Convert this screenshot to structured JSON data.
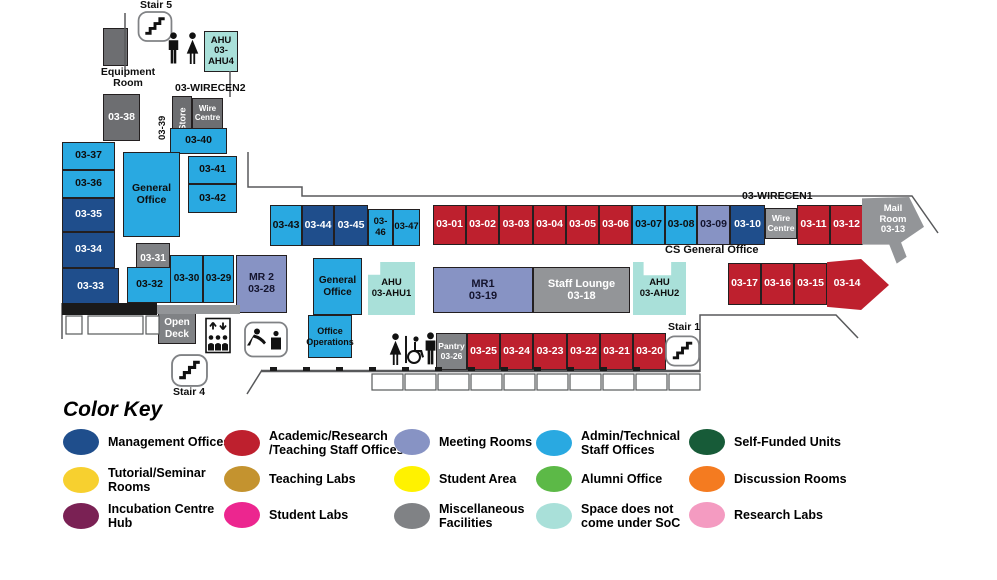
{
  "palette": {
    "admin_technical": "#29A9E1",
    "management": "#1F4E8C",
    "academic": "#BE202E",
    "meeting": "#8793C4",
    "misc_dark": "#6D6E71",
    "misc": "#808285",
    "misc_light": "#939598",
    "not_soc": "#A9E0D9",
    "tutorial": "#F7D02F",
    "teaching_labs": "#C4932F",
    "student_area": "#FFF200",
    "alumni": "#5CB947",
    "self_funded": "#175B38",
    "discussion": "#F47B20",
    "incubation": "#7A2154",
    "student_labs": "#EC268F",
    "research": "#F49BC1"
  },
  "map": {
    "rooms": [
      {
        "name": "room-equipment-box",
        "label": "",
        "x": 103,
        "y": 28,
        "w": 25,
        "h": 38,
        "bg": "#6D6E71",
        "fg": "#fff",
        "fs": 10
      },
      {
        "name": "room-ahu4",
        "label": "AHU\n03-AHU4",
        "x": 204,
        "y": 31,
        "w": 34,
        "h": 41,
        "bg": "#A9E0D9",
        "fg": "#0e0e0e",
        "fs": 9.5
      },
      {
        "name": "room-03-38",
        "label": "03-38",
        "x": 103,
        "y": 94,
        "w": 37,
        "h": 47,
        "bg": "#6D6E71",
        "fg": "#fff",
        "fs": 10.5
      },
      {
        "name": "room-store",
        "label": "Store",
        "x": 172,
        "y": 96,
        "w": 20,
        "h": 47,
        "bg": "#6D6E71",
        "fg": "#fff",
        "fs": 9,
        "vertical": true
      },
      {
        "name": "room-wire-centre-2",
        "label": "Wire\nCentre",
        "x": 192,
        "y": 98,
        "w": 31,
        "h": 31,
        "bg": "#6D6E71",
        "fg": "#fff",
        "fs": 8
      },
      {
        "name": "room-03-40",
        "label": "03-40",
        "x": 170,
        "y": 128,
        "w": 57,
        "h": 26,
        "bg": "#29A9E1",
        "fg": "#0e0e0e",
        "fs": 10.5
      },
      {
        "name": "room-03-37",
        "label": "03-37",
        "x": 62,
        "y": 142,
        "w": 53,
        "h": 28,
        "bg": "#29A9E1",
        "fg": "#0e0e0e",
        "fs": 10.5
      },
      {
        "name": "room-03-36",
        "label": "03-36",
        "x": 62,
        "y": 170,
        "w": 53,
        "h": 28,
        "bg": "#29A9E1",
        "fg": "#0e0e0e",
        "fs": 10.5
      },
      {
        "name": "room-03-35",
        "label": "03-35",
        "x": 62,
        "y": 198,
        "w": 53,
        "h": 34,
        "bg": "#1F4E8C",
        "fg": "#fff",
        "fs": 10.5
      },
      {
        "name": "room-03-34",
        "label": "03-34",
        "x": 62,
        "y": 232,
        "w": 53,
        "h": 36,
        "bg": "#1F4E8C",
        "fg": "#fff",
        "fs": 10.5
      },
      {
        "name": "room-03-33",
        "label": "03-33",
        "x": 62,
        "y": 268,
        "w": 57,
        "h": 37,
        "bg": "#1F4E8C",
        "fg": "#fff",
        "fs": 10.5
      },
      {
        "name": "room-general-office-west",
        "label": "General\nOffice",
        "x": 123,
        "y": 152,
        "w": 57,
        "h": 85,
        "bg": "#29A9E1",
        "fg": "#0e0e0e",
        "fs": 10.5
      },
      {
        "name": "room-03-41",
        "label": "03-41",
        "x": 188,
        "y": 156,
        "w": 49,
        "h": 28,
        "bg": "#29A9E1",
        "fg": "#0e0e0e",
        "fs": 10.5
      },
      {
        "name": "room-03-42",
        "label": "03-42",
        "x": 188,
        "y": 184,
        "w": 49,
        "h": 29,
        "bg": "#29A9E1",
        "fg": "#0e0e0e",
        "fs": 10.5
      },
      {
        "name": "room-03-31",
        "label": "03-31",
        "x": 136,
        "y": 243,
        "w": 34,
        "h": 32,
        "bg": "#808285",
        "fg": "#fff",
        "fs": 10
      },
      {
        "name": "room-03-32",
        "label": "03-32",
        "x": 127,
        "y": 267,
        "w": 45,
        "h": 36,
        "bg": "#29A9E1",
        "fg": "#0e0e0e",
        "fs": 10.5
      },
      {
        "name": "room-03-30",
        "label": "03-30",
        "x": 170,
        "y": 255,
        "w": 33,
        "h": 48,
        "bg": "#29A9E1",
        "fg": "#0e0e0e",
        "fs": 10
      },
      {
        "name": "room-03-29",
        "label": "03-29",
        "x": 203,
        "y": 255,
        "w": 31,
        "h": 48,
        "bg": "#29A9E1",
        "fg": "#0e0e0e",
        "fs": 10
      },
      {
        "name": "room-mr2",
        "label": "MR 2\n03-28",
        "x": 236,
        "y": 255,
        "w": 51,
        "h": 58,
        "bg": "#8793C4",
        "fg": "#14142e",
        "fs": 10.5
      },
      {
        "name": "room-open-deck",
        "label": "Open\nDeck",
        "x": 158,
        "y": 313,
        "w": 38,
        "h": 31,
        "bg": "#808285",
        "fg": "#fff",
        "fs": 10
      },
      {
        "name": "room-03-43",
        "label": "03-43",
        "x": 270,
        "y": 205,
        "w": 32,
        "h": 41,
        "bg": "#29A9E1",
        "fg": "#0e0e0e",
        "fs": 10.5
      },
      {
        "name": "room-03-44",
        "label": "03-44",
        "x": 302,
        "y": 205,
        "w": 32,
        "h": 41,
        "bg": "#1F4E8C",
        "fg": "#fff",
        "fs": 10.5
      },
      {
        "name": "room-03-45",
        "label": "03-45",
        "x": 334,
        "y": 205,
        "w": 34,
        "h": 41,
        "bg": "#1F4E8C",
        "fg": "#fff",
        "fs": 10.5
      },
      {
        "name": "room-03-46",
        "label": "03-46",
        "x": 368,
        "y": 209,
        "w": 25,
        "h": 37,
        "bg": "#29A9E1",
        "fg": "#0e0e0e",
        "fs": 9.5
      },
      {
        "name": "room-03-47",
        "label": "03-47",
        "x": 393,
        "y": 209,
        "w": 27,
        "h": 37,
        "bg": "#29A9E1",
        "fg": "#0e0e0e",
        "fs": 9.5
      },
      {
        "name": "room-general-office-mid",
        "label": "General\nOffice",
        "x": 313,
        "y": 258,
        "w": 49,
        "h": 57,
        "bg": "#29A9E1",
        "fg": "#0e0e0e",
        "fs": 10
      },
      {
        "name": "room-office-operations",
        "label": "Office\nOperations",
        "x": 308,
        "y": 315,
        "w": 44,
        "h": 43,
        "bg": "#29A9E1",
        "fg": "#0e0e0e",
        "fs": 9
      },
      {
        "name": "room-ahu1",
        "label": "AHU\n03-AHU1",
        "x": 368,
        "y": 262,
        "w": 47,
        "h": 53,
        "bg": "#A9E0D9",
        "fg": "#0e0e0e",
        "fs": 9.5,
        "clip": "polygon(0 24%, 26% 24%, 26% 0, 100% 0, 100% 100%, 0 100%)"
      },
      {
        "name": "room-03-01",
        "label": "03-01",
        "x": 433,
        "y": 205,
        "w": 33,
        "h": 40,
        "bg": "#BE202E",
        "fg": "#fff",
        "fs": 10.5
      },
      {
        "name": "room-03-02",
        "label": "03-02",
        "x": 466,
        "y": 205,
        "w": 33,
        "h": 40,
        "bg": "#BE202E",
        "fg": "#fff",
        "fs": 10.5
      },
      {
        "name": "room-03-03",
        "label": "03-03",
        "x": 499,
        "y": 205,
        "w": 34,
        "h": 40,
        "bg": "#BE202E",
        "fg": "#fff",
        "fs": 10.5
      },
      {
        "name": "room-03-04",
        "label": "03-04",
        "x": 533,
        "y": 205,
        "w": 33,
        "h": 40,
        "bg": "#BE202E",
        "fg": "#fff",
        "fs": 10.5
      },
      {
        "name": "room-03-05",
        "label": "03-05",
        "x": 566,
        "y": 205,
        "w": 33,
        "h": 40,
        "bg": "#BE202E",
        "fg": "#fff",
        "fs": 10.5
      },
      {
        "name": "room-03-06",
        "label": "03-06",
        "x": 599,
        "y": 205,
        "w": 33,
        "h": 40,
        "bg": "#BE202E",
        "fg": "#fff",
        "fs": 10.5
      },
      {
        "name": "room-03-07",
        "label": "03-07",
        "x": 632,
        "y": 205,
        "w": 33,
        "h": 40,
        "bg": "#29A9E1",
        "fg": "#0e0e0e",
        "fs": 10.5
      },
      {
        "name": "room-03-08",
        "label": "03-08",
        "x": 665,
        "y": 205,
        "w": 32,
        "h": 40,
        "bg": "#29A9E1",
        "fg": "#0e0e0e",
        "fs": 10.5
      },
      {
        "name": "room-03-09",
        "label": "03-09",
        "x": 697,
        "y": 205,
        "w": 33,
        "h": 40,
        "bg": "#8793C4",
        "fg": "#14142e",
        "fs": 10.5
      },
      {
        "name": "room-03-10",
        "label": "03-10",
        "x": 730,
        "y": 205,
        "w": 35,
        "h": 40,
        "bg": "#1F4E8C",
        "fg": "#fff",
        "fs": 10.5
      },
      {
        "name": "room-wire-centre-1",
        "label": "Wire\nCentre",
        "x": 765,
        "y": 208,
        "w": 32,
        "h": 31,
        "bg": "#939598",
        "fg": "#fff",
        "fs": 8.5
      },
      {
        "name": "room-03-11",
        "label": "03-11",
        "x": 797,
        "y": 205,
        "w": 33,
        "h": 40,
        "bg": "#BE202E",
        "fg": "#fff",
        "fs": 10.5
      },
      {
        "name": "room-03-12",
        "label": "03-12",
        "x": 830,
        "y": 205,
        "w": 33,
        "h": 40,
        "bg": "#BE202E",
        "fg": "#fff",
        "fs": 10.5
      },
      {
        "name": "room-mail-room",
        "label": "Mail\nRoom\n03-13",
        "x": 862,
        "y": 197,
        "w": 62,
        "h": 68,
        "bg": "#939598",
        "fg": "#fff",
        "fs": 9.5,
        "clip": "polygon(0 2%, 76% 0, 100% 44%, 63% 67%, 72% 88%, 56% 98%, 44% 70%, 0 70%)",
        "padB": 22
      },
      {
        "name": "room-03-17",
        "label": "03-17",
        "x": 728,
        "y": 263,
        "w": 33,
        "h": 42,
        "bg": "#BE202E",
        "fg": "#fff",
        "fs": 10.5
      },
      {
        "name": "room-03-16",
        "label": "03-16",
        "x": 761,
        "y": 263,
        "w": 33,
        "h": 42,
        "bg": "#BE202E",
        "fg": "#fff",
        "fs": 10.5
      },
      {
        "name": "room-03-15",
        "label": "03-15",
        "x": 794,
        "y": 263,
        "w": 33,
        "h": 42,
        "bg": "#BE202E",
        "fg": "#fff",
        "fs": 10.5
      },
      {
        "name": "room-03-14",
        "label": "03-14",
        "x": 827,
        "y": 258,
        "w": 62,
        "h": 52,
        "bg": "#BE202E",
        "fg": "#fff",
        "fs": 10.5,
        "clip": "polygon(0 8%, 55% 2%, 100% 52%, 55% 100%, 0 94%)",
        "padR": 22
      },
      {
        "name": "room-mr1",
        "label": "MR1\n03-19",
        "x": 433,
        "y": 267,
        "w": 100,
        "h": 46,
        "bg": "#8793C4",
        "fg": "#14142e",
        "fs": 11
      },
      {
        "name": "room-staff-lounge",
        "label": "Staff Lounge\n03-18",
        "x": 533,
        "y": 267,
        "w": 97,
        "h": 46,
        "bg": "#939598",
        "fg": "#fff",
        "fs": 11
      },
      {
        "name": "room-ahu2",
        "label": "AHU\n03-AHU2",
        "x": 633,
        "y": 262,
        "w": 53,
        "h": 53,
        "bg": "#A9E0D9",
        "fg": "#0e0e0e",
        "fs": 9.5,
        "clip": "polygon(0 0, 20% 0, 20% 25%, 72% 25%, 72% 0, 100% 0, 100% 100%, 0 100%)"
      },
      {
        "name": "room-pantry",
        "label": "Pantry\n03-26",
        "x": 436,
        "y": 333,
        "w": 31,
        "h": 37,
        "bg": "#808285",
        "fg": "#fff",
        "fs": 8.5
      },
      {
        "name": "room-03-25",
        "label": "03-25",
        "x": 467,
        "y": 333,
        "w": 33,
        "h": 37,
        "bg": "#BE202E",
        "fg": "#fff",
        "fs": 10.5
      },
      {
        "name": "room-03-24",
        "label": "03-24",
        "x": 500,
        "y": 333,
        "w": 33,
        "h": 37,
        "bg": "#BE202E",
        "fg": "#fff",
        "fs": 10.5
      },
      {
        "name": "room-03-23",
        "label": "03-23",
        "x": 533,
        "y": 333,
        "w": 34,
        "h": 37,
        "bg": "#BE202E",
        "fg": "#fff",
        "fs": 10.5
      },
      {
        "name": "room-03-22",
        "label": "03-22",
        "x": 567,
        "y": 333,
        "w": 33,
        "h": 37,
        "bg": "#BE202E",
        "fg": "#fff",
        "fs": 10.5
      },
      {
        "name": "room-03-21",
        "label": "03-21",
        "x": 600,
        "y": 333,
        "w": 33,
        "h": 37,
        "bg": "#BE202E",
        "fg": "#fff",
        "fs": 10.5
      },
      {
        "name": "room-03-20",
        "label": "03-20",
        "x": 633,
        "y": 333,
        "w": 33,
        "h": 37,
        "bg": "#BE202E",
        "fg": "#fff",
        "fs": 10.5
      }
    ],
    "labels": [
      {
        "name": "stair5-label",
        "text": "Stair 5",
        "x": 136,
        "y": 0,
        "w": 40,
        "fs": 10.5,
        "align": "center"
      },
      {
        "name": "equipment-room-label",
        "text": "Equipment\nRoom",
        "x": 96,
        "y": 67,
        "w": 64,
        "fs": 10.5,
        "align": "center"
      },
      {
        "name": "wirecen2-label",
        "text": "03-WIRECEN2",
        "x": 175,
        "y": 83,
        "fs": 10.5
      },
      {
        "name": "room-03-39-label",
        "text": "03-39",
        "x": 158,
        "y": 140,
        "fs": 9.5,
        "vertical": true
      },
      {
        "name": "stair4-label",
        "text": "Stair 4",
        "x": 169,
        "y": 387,
        "w": 40,
        "fs": 10.5,
        "align": "center"
      },
      {
        "name": "stair1-label",
        "text": "Stair 1",
        "x": 663,
        "y": 322,
        "w": 42,
        "fs": 10.5,
        "align": "center"
      },
      {
        "name": "wirecen1-label",
        "text": "03-WIRECEN1",
        "x": 742,
        "y": 191,
        "fs": 10.5
      },
      {
        "name": "cs-general-office-label",
        "text": "CS General Office",
        "x": 665,
        "y": 245,
        "fs": 11
      }
    ],
    "icons": [
      {
        "type": "stair",
        "name": "stair5-icon",
        "x": 137,
        "y": 11,
        "w": 36,
        "h": 31
      },
      {
        "type": "male",
        "name": "male-restroom-icon-top",
        "x": 166,
        "y": 32,
        "w": 15,
        "h": 33
      },
      {
        "type": "female",
        "name": "female-restroom-icon-top",
        "x": 184,
        "y": 32,
        "w": 17,
        "h": 33
      },
      {
        "type": "stair",
        "name": "stair4-icon",
        "x": 171,
        "y": 354,
        "w": 37,
        "h": 33
      },
      {
        "type": "stair",
        "name": "stair1-icon",
        "x": 665,
        "y": 335,
        "w": 35,
        "h": 32
      },
      {
        "type": "elevator",
        "name": "elevator-icon",
        "x": 205,
        "y": 317,
        "w": 26,
        "h": 37
      },
      {
        "type": "watercooler",
        "name": "water-cooler-icon",
        "x": 244,
        "y": 321,
        "w": 44,
        "h": 37
      },
      {
        "type": "female",
        "name": "female-restroom-icon-bottom",
        "x": 387,
        "y": 333,
        "w": 17,
        "h": 33
      },
      {
        "type": "divider",
        "name": "restroom-divider",
        "x": 404,
        "y": 334,
        "w": 4,
        "h": 31
      },
      {
        "type": "wheelchair",
        "name": "wheelchair-icon",
        "x": 406,
        "y": 336,
        "w": 18,
        "h": 28
      },
      {
        "type": "male",
        "name": "male-restroom-icon-bottom",
        "x": 423,
        "y": 332,
        "w": 15,
        "h": 34
      }
    ]
  },
  "legend": {
    "title": "Color Key",
    "items": [
      {
        "name": "legend-management-offices",
        "label": "Management Offices",
        "color": "#1F4E8C",
        "x": 63,
        "y": 429
      },
      {
        "name": "legend-academic-offices",
        "label": "Academic/Research\n/Teaching Staff Offices",
        "color": "#BE202E",
        "x": 224,
        "y": 429
      },
      {
        "name": "legend-meeting-rooms",
        "label": "Meeting Rooms",
        "color": "#8793C4",
        "x": 394,
        "y": 429
      },
      {
        "name": "legend-admin-offices",
        "label": "Admin/Technical\nStaff Offices",
        "color": "#29A9E1",
        "x": 536,
        "y": 429
      },
      {
        "name": "legend-self-funded-units",
        "label": "Self-Funded Units",
        "color": "#175B38",
        "x": 689,
        "y": 429
      },
      {
        "name": "legend-tutorial-rooms",
        "label": "Tutorial/Seminar\nRooms",
        "color": "#F7D02F",
        "x": 63,
        "y": 466
      },
      {
        "name": "legend-teaching-labs",
        "label": "Teaching Labs",
        "color": "#C4932F",
        "x": 224,
        "y": 466
      },
      {
        "name": "legend-student-area",
        "label": "Student Area",
        "color": "#FFF200",
        "x": 394,
        "y": 466
      },
      {
        "name": "legend-alumni-office",
        "label": "Alumni Office",
        "color": "#5CB947",
        "x": 536,
        "y": 466
      },
      {
        "name": "legend-discussion-rooms",
        "label": "Discussion Rooms",
        "color": "#F47B20",
        "x": 689,
        "y": 466
      },
      {
        "name": "legend-incubation-hub",
        "label": "Incubation Centre\nHub",
        "color": "#7A2154",
        "x": 63,
        "y": 502
      },
      {
        "name": "legend-student-labs",
        "label": "Student  Labs",
        "color": "#EC268F",
        "x": 224,
        "y": 502
      },
      {
        "name": "legend-misc-facilities",
        "label": "Miscellaneous\nFacilities",
        "color": "#808285",
        "x": 394,
        "y": 502
      },
      {
        "name": "legend-not-soc",
        "label": "Space does not\ncome under SoC",
        "color": "#A9E0D9",
        "x": 536,
        "y": 502
      },
      {
        "name": "legend-research-labs",
        "label": "Research Labs",
        "color": "#F49BC1",
        "x": 689,
        "y": 502
      }
    ]
  }
}
